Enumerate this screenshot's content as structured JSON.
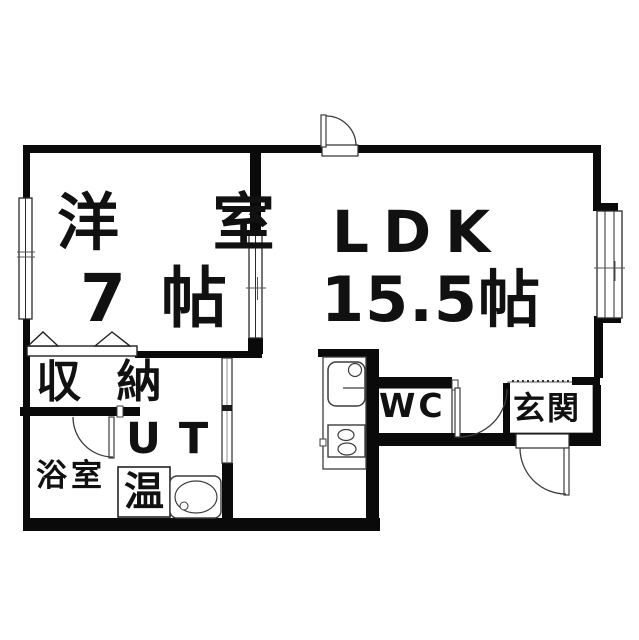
{
  "plan_type": "apartment-floor-plan",
  "colors": {
    "wall": "#0a0a0a",
    "fixture_line": "#3c3c3c",
    "background": "#ffffff",
    "text": "#111111"
  },
  "rooms": {
    "western_room": {
      "label": "洋 室",
      "size": "7 帖"
    },
    "ldk": {
      "label": "LDK",
      "size": "15.5帖"
    },
    "closet": {
      "label": "収 納"
    },
    "utility": {
      "label": "UT"
    },
    "bathroom": {
      "label": "浴室"
    },
    "water_heater": {
      "label": "温"
    },
    "wc": {
      "label": "WC"
    },
    "entrance": {
      "label": "玄関"
    }
  },
  "fixtures": [
    "kitchen-sink",
    "gas-stove",
    "wash-basin",
    "water-heater-box",
    "closet-folding-doors",
    "entrance-door",
    "bathroom-door",
    "hall-door",
    "back-door",
    "window-left",
    "window-right",
    "window-room-divider",
    "ut-sliding-door",
    "genkan-step"
  ]
}
